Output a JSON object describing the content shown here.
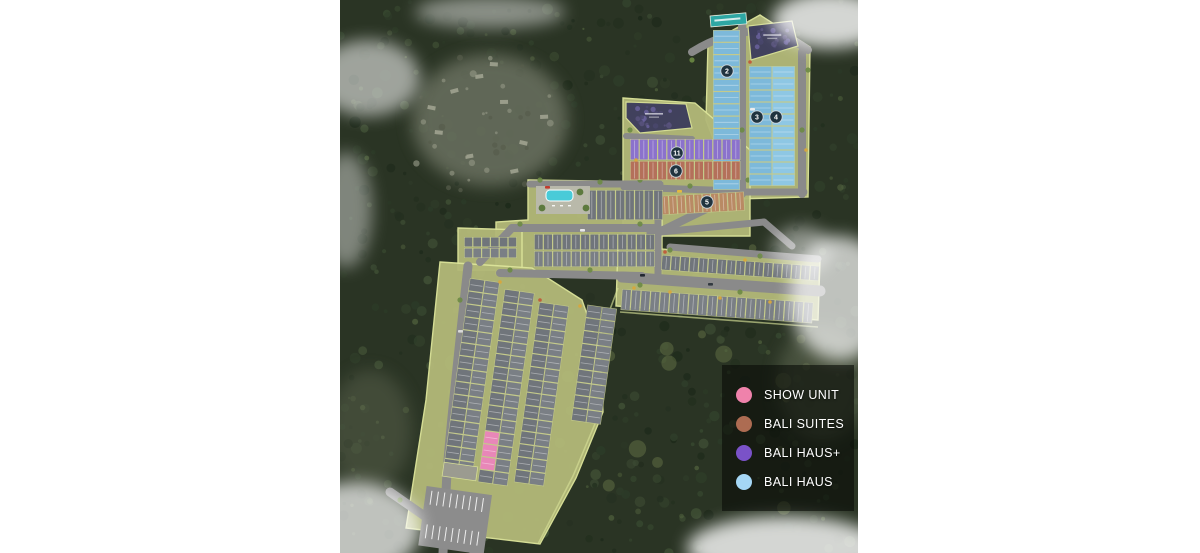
{
  "title": "Residential estate site plan (aerial view)",
  "legend": {
    "items": [
      {
        "key": "show-unit",
        "label": "SHOW UNIT",
        "color": "#ef82ab"
      },
      {
        "key": "bali-suites",
        "label": "BALI SUITES",
        "color": "#ad6c52"
      },
      {
        "key": "bali-haus-plus",
        "label": "BALI HAUS+",
        "color": "#7a52c8"
      },
      {
        "key": "bali-haus",
        "label": "BALI HAUS",
        "color": "#a5d7f5"
      }
    ]
  },
  "unit_colors": {
    "bali-haus": "#7db9da",
    "bali-haus-alt": "#8ec7e4",
    "bali-haus-plus": "#8b72cc",
    "bali-suites": "#b4705a",
    "bali-suites-tan": "#b98a64",
    "standard": "#70757b",
    "standard-alt": "#7a7f85",
    "show-unit": "#e887b8"
  },
  "map": {
    "colors": {
      "forest": "#2a3424",
      "parcel": "#b2b878",
      "parcel-edge": "#dce49a",
      "road": "#8a8a8a",
      "pool": "#49cbd8",
      "banner": "#2ea7a4",
      "future-parcel": "#3c3c5c",
      "marker": "#20333f"
    },
    "parcels": [
      {
        "name": "north-cluster",
        "points": "368,44 420,15 470,47 468,197 396,199 366,120"
      },
      {
        "name": "middle-cluster",
        "points": "283,98 355,103 410,150 410,236 283,236"
      },
      {
        "name": "pool-cluster",
        "points": "188,180 322,182 322,274 156,274 156,222 188,220"
      },
      {
        "name": "west-block",
        "points": "118,228 182,230 182,270 118,270"
      },
      {
        "name": "east-bands",
        "points": "278,246 480,260 478,320 276,306"
      },
      {
        "name": "south-cluster",
        "points": "100,262 192,268 242,300 260,352 263,412 236,478 200,544 66,528 86,400"
      }
    ],
    "boundaries": [
      {
        "d": "M 278,288 L 254,352 L 260,412 L 233,476 L 198,544"
      },
      {
        "d": "M 280,312 L 478,327"
      },
      {
        "d": "M 352,52 Q 418,10 470,50"
      }
    ],
    "roads": [
      {
        "d": "M 352,52 Q 418,12 468,50",
        "w": 8
      },
      {
        "d": "M 402,26 L 402,194",
        "w": 8
      },
      {
        "d": "M 462,52 L 462,194",
        "w": 8
      },
      {
        "d": "M 398,192 L 464,192",
        "w": 7
      },
      {
        "d": "M 399,193 L 317,233",
        "w": 8
      },
      {
        "d": "M 284,187 L 398,191",
        "w": 7
      },
      {
        "d": "M 286,136 L 352,139",
        "w": 6
      },
      {
        "d": "M 190,184 L 320,184",
        "w": 7
      },
      {
        "d": "M 172,228 L 318,228",
        "w": 8
      },
      {
        "d": "M 318,184 L 318,278",
        "w": 7
      },
      {
        "d": "M 160,273 L 302,276",
        "w": 8
      },
      {
        "d": "M 140,262 L 172,228",
        "w": 8
      },
      {
        "d": "M 128,266 C 120,340 112,410 107,472",
        "w": 9
      },
      {
        "d": "M 107,472 L 103,553",
        "w": 9
      },
      {
        "d": "M 282,277 L 480,291",
        "w": 11
      },
      {
        "d": "M 310,233 L 424,222",
        "w": 7
      },
      {
        "d": "M 424,222 L 452,246",
        "w": 7
      },
      {
        "d": "M 330,247 L 478,259",
        "w": 7
      },
      {
        "d": "M 50,492 L 132,549",
        "w": 9
      }
    ],
    "rows": [
      {
        "name": "bali-haus-west-column",
        "type": "bali-haus",
        "x": 373,
        "y": 30,
        "dir": "v",
        "step": 12.3,
        "count": 13,
        "depth": 27,
        "rot": 0
      },
      {
        "name": "bali-haus-block-left",
        "type": "bali-haus",
        "x": 409,
        "y": 66,
        "dir": "v",
        "step": 12,
        "count": 10,
        "depth": 23,
        "rot": 0
      },
      {
        "name": "bali-haus-block-right",
        "type": "bali-haus-alt",
        "x": 432,
        "y": 66,
        "dir": "v",
        "step": 12,
        "count": 10,
        "depth": 23,
        "rot": 0
      },
      {
        "name": "bali-haus-plus-row",
        "type": "bali-haus-plus",
        "x": 290,
        "y": 139,
        "dir": "h",
        "step": 9.2,
        "count": 12,
        "depth": 21,
        "rot": 0
      },
      {
        "name": "bali-suites-row",
        "type": "bali-suites",
        "x": 290,
        "y": 161,
        "dir": "h",
        "step": 9.2,
        "count": 12,
        "depth": 19,
        "rot": 0
      },
      {
        "name": "bali-suites-south-row",
        "type": "bali-suites-tan",
        "x": 320,
        "y": 196,
        "dir": "h",
        "step": 8.4,
        "count": 10,
        "depth": 19,
        "rot": -3
      },
      {
        "name": "pool-side-row",
        "type": "standard",
        "x": 247,
        "y": 190,
        "dir": "h",
        "step": 9.5,
        "count": 8,
        "depth": 30,
        "rot": 0
      },
      {
        "name": "central-row-1",
        "type": "standard",
        "x": 194,
        "y": 234,
        "dir": "h",
        "step": 9.3,
        "count": 13,
        "depth": 16,
        "rot": 0
      },
      {
        "name": "central-row-2",
        "type": "standard-alt",
        "x": 194,
        "y": 251,
        "dir": "h",
        "step": 9.3,
        "count": 13,
        "depth": 16,
        "rot": 0
      },
      {
        "name": "east-band-top",
        "type": "standard",
        "x": 322,
        "y": 255,
        "dir": "h",
        "step": 9.3,
        "count": 17,
        "depth": 15,
        "rot": 4
      },
      {
        "name": "east-band-bottom",
        "type": "standard-alt",
        "x": 282,
        "y": 289,
        "dir": "h",
        "step": 9.6,
        "count": 20,
        "depth": 21,
        "rot": 4
      },
      {
        "name": "west-block-row-1",
        "type": "standard",
        "x": 124,
        "y": 237,
        "dir": "h",
        "step": 8.8,
        "count": 6,
        "depth": 10,
        "rot": 0
      },
      {
        "name": "west-block-row-2",
        "type": "standard-alt",
        "x": 124,
        "y": 248,
        "dir": "h",
        "step": 8.8,
        "count": 6,
        "depth": 10,
        "rot": 0
      },
      {
        "name": "south-strip-1a",
        "type": "standard",
        "x": 130,
        "y": 278,
        "dir": "v",
        "step": 13,
        "count": 15,
        "depth": 15,
        "rot": 8
      },
      {
        "name": "south-strip-1b",
        "type": "standard-alt",
        "x": 144.9,
        "y": 280.1,
        "dir": "v",
        "step": 13,
        "count": 15,
        "depth": 15,
        "rot": 8
      },
      {
        "name": "south-strip-2a",
        "type": "standard",
        "x": 164.8,
        "y": 288.9,
        "dir": "v",
        "step": 13,
        "count": 15,
        "depth": 15,
        "rot": 8,
        "pink": [
          11,
          12,
          13
        ]
      },
      {
        "name": "south-strip-2b",
        "type": "standard-alt",
        "x": 179.7,
        "y": 291.0,
        "dir": "v",
        "step": 13,
        "count": 15,
        "depth": 15,
        "rot": 8
      },
      {
        "name": "south-strip-3a",
        "type": "standard",
        "x": 199.3,
        "y": 301.9,
        "dir": "v",
        "step": 13,
        "count": 14,
        "depth": 15,
        "rot": 8
      },
      {
        "name": "south-strip-3b",
        "type": "standard-alt",
        "x": 214.2,
        "y": 304.0,
        "dir": "v",
        "step": 13,
        "count": 14,
        "depth": 15,
        "rot": 8
      },
      {
        "name": "south-strip-4a",
        "type": "standard",
        "x": 247.4,
        "y": 304.6,
        "dir": "v",
        "step": 13,
        "count": 9,
        "depth": 15,
        "rot": 8
      },
      {
        "name": "south-strip-4b",
        "type": "standard-alt",
        "x": 262.2,
        "y": 306.7,
        "dir": "v",
        "step": 13,
        "count": 9,
        "depth": 15,
        "rot": 8
      }
    ],
    "markers": [
      {
        "x": 387,
        "y": 71,
        "label": "2"
      },
      {
        "x": 417,
        "y": 117,
        "label": "3"
      },
      {
        "x": 436,
        "y": 117,
        "label": "4"
      },
      {
        "x": 337,
        "y": 153,
        "label": "11"
      },
      {
        "x": 336,
        "y": 171,
        "label": "6"
      },
      {
        "x": 367,
        "y": 202,
        "label": "5"
      }
    ],
    "future_parcels": [
      {
        "name": "northeast-future-parcel",
        "points": "408,26 452,21 458,46 411,60"
      },
      {
        "name": "middle-future-parcel",
        "points": "286,102 346,104 352,128 300,133 286,118"
      }
    ],
    "banner": {
      "x": 370,
      "y": 16,
      "w": 36,
      "h": 11,
      "rot": -5
    },
    "pool": {
      "deck": {
        "x": 196,
        "y": 186,
        "w": 54,
        "h": 28
      },
      "water": {
        "x": 206,
        "y": 190,
        "w": 27,
        "h": 11
      }
    },
    "parking": {
      "x": 86.6,
      "y": 486,
      "w": 66,
      "h": 60,
      "rot": 8
    },
    "clearings": [
      {
        "cx": 150,
        "cy": 120,
        "rx": 78,
        "ry": 66,
        "fill": "#6a7160",
        "op": 0.85
      },
      {
        "cx": 482,
        "cy": 382,
        "rx": 45,
        "ry": 58,
        "fill": "#5c6550",
        "op": 0.6
      },
      {
        "cx": 30,
        "cy": 430,
        "rx": 42,
        "ry": 60,
        "fill": "#5a624e",
        "op": 0.5
      }
    ],
    "clouds": [
      {
        "cx": 28,
        "cy": 78,
        "rx": 52,
        "ry": 38,
        "op": 0.55
      },
      {
        "cx": 150,
        "cy": 12,
        "rx": 75,
        "ry": 16,
        "op": 0.45
      },
      {
        "cx": 490,
        "cy": 20,
        "rx": 58,
        "ry": 28,
        "op": 0.8
      },
      {
        "cx": 500,
        "cy": 298,
        "rx": 50,
        "ry": 62,
        "op": 0.7
      },
      {
        "cx": 462,
        "cy": 250,
        "rx": 30,
        "ry": 24,
        "op": 0.45
      },
      {
        "cx": 445,
        "cy": 548,
        "rx": 98,
        "ry": 32,
        "op": 0.8
      },
      {
        "cx": 15,
        "cy": 528,
        "rx": 66,
        "ry": 46,
        "op": 0.7
      },
      {
        "cx": 6,
        "cy": 210,
        "rx": 26,
        "ry": 58,
        "op": 0.4
      }
    ]
  }
}
